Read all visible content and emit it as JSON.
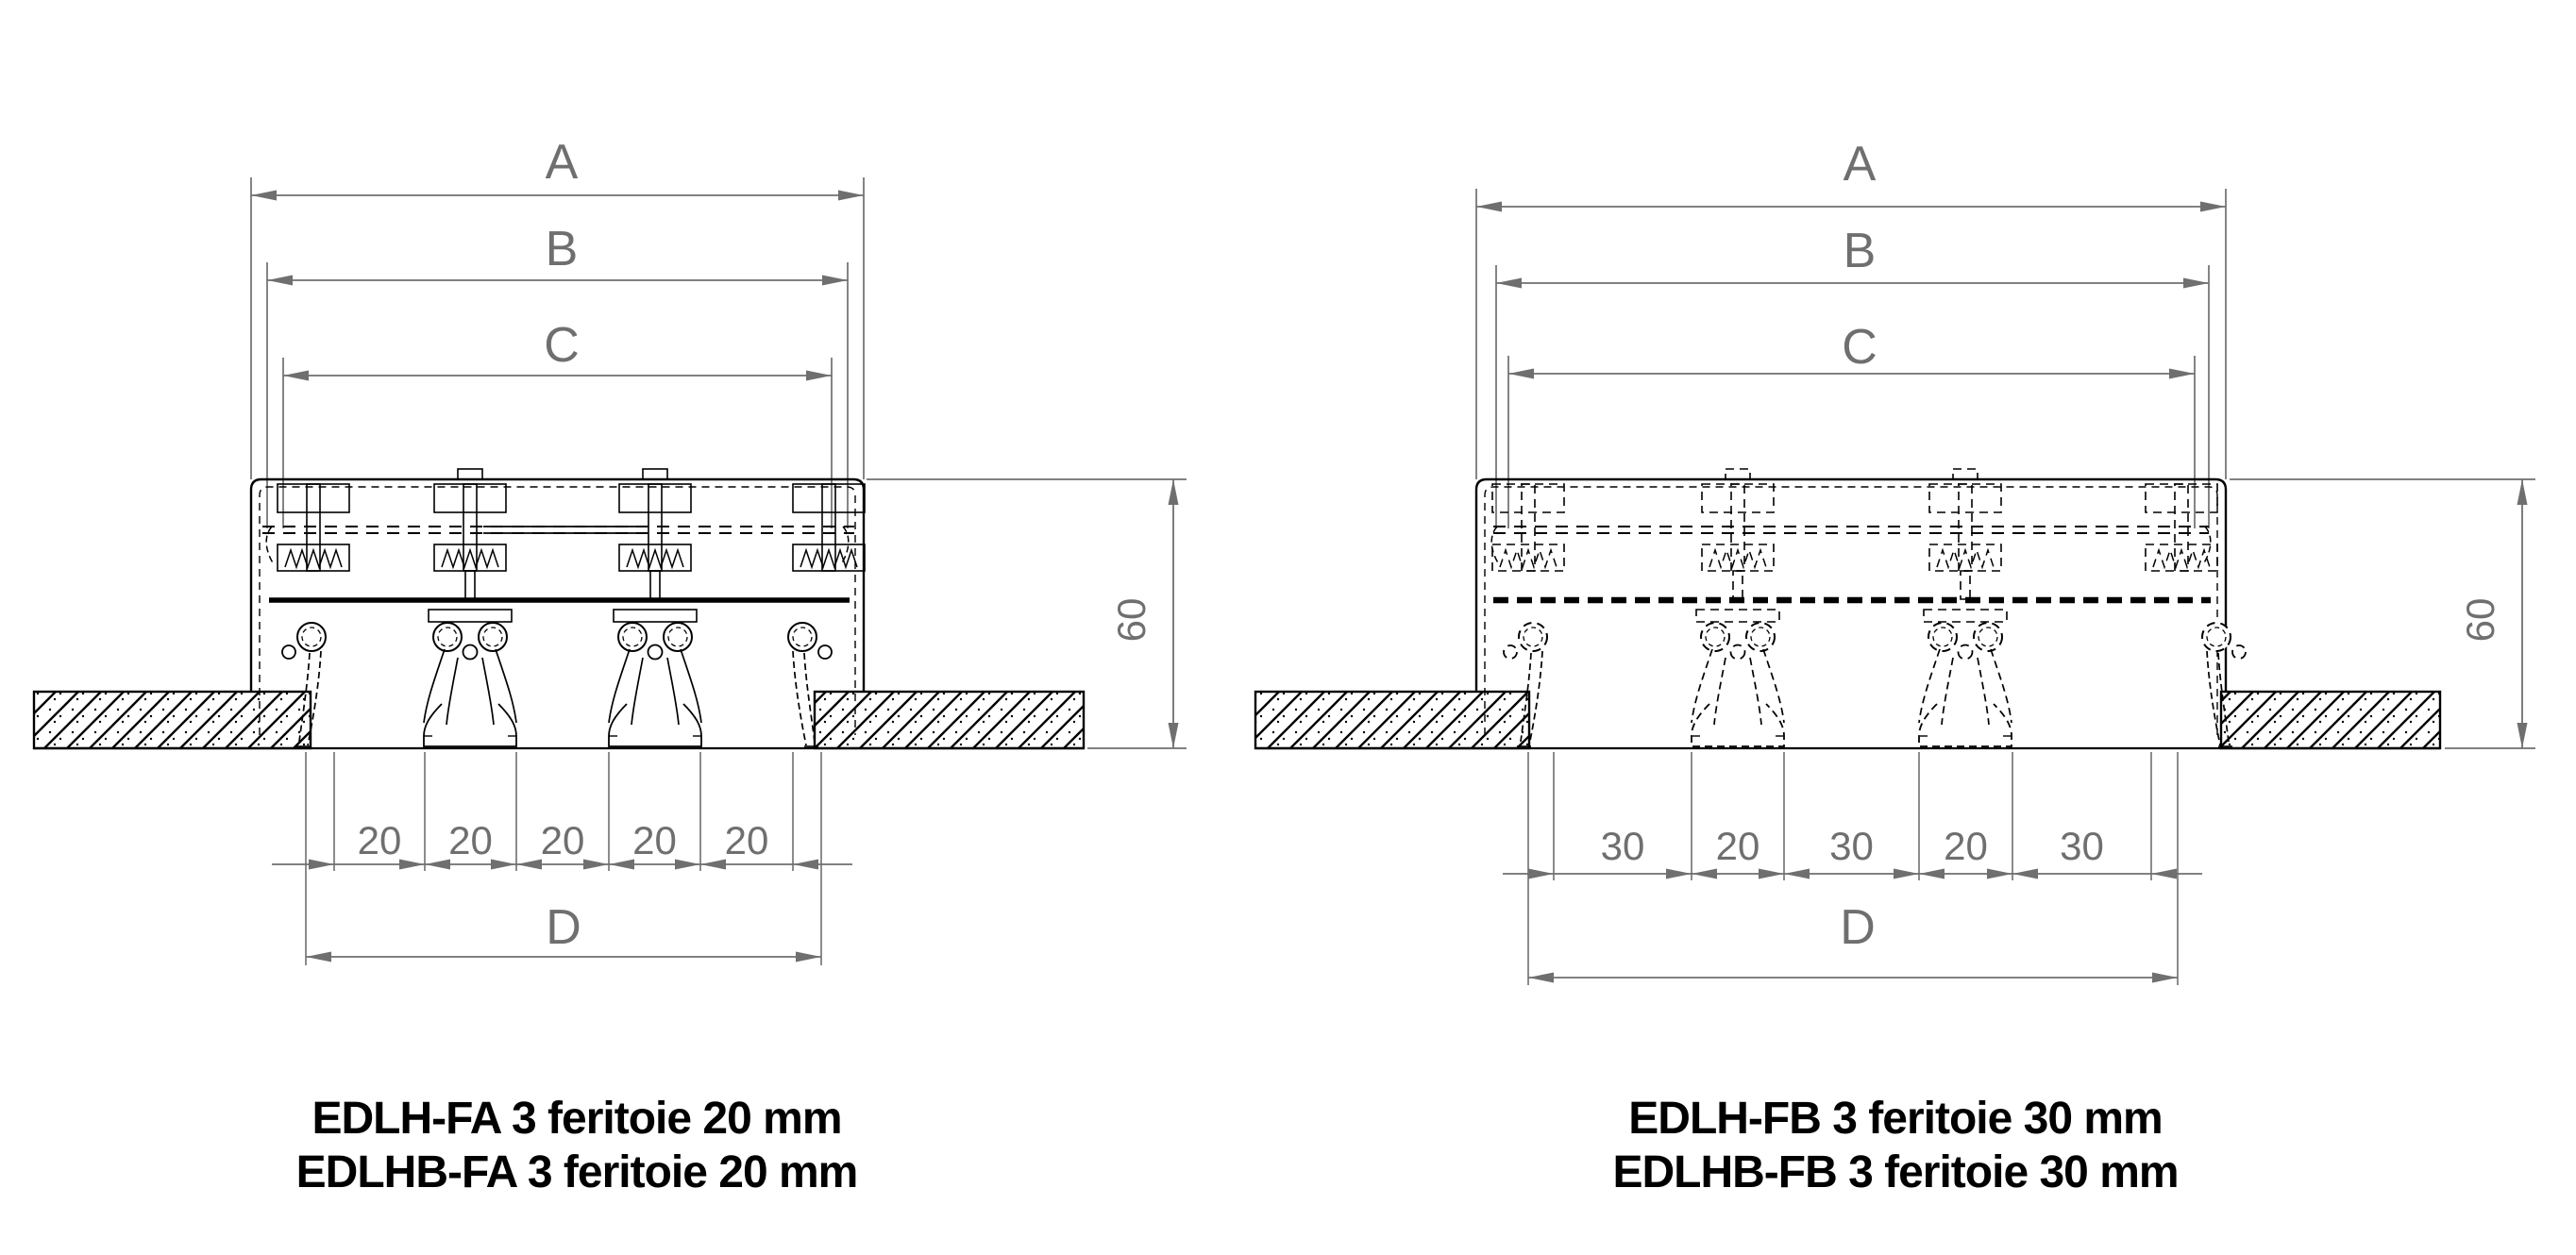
{
  "figure": {
    "background": "#ffffff",
    "ink_color": "#000000",
    "dim_color": "#6f6f6f",
    "drawings": [
      {
        "id": "edlh-fa",
        "line_style": "solid",
        "width_dim_labels": [
          "A",
          "B",
          "C"
        ],
        "slot_width_labels": [
          "20",
          "20",
          "20",
          "20",
          "20"
        ],
        "overall_width_label": "D",
        "height_label": "60",
        "caption_lines": [
          "EDLH-FA 3 feritoie 20 mm",
          "EDLHB-FA 3 feritoie 20 mm"
        ]
      },
      {
        "id": "edlh-fb",
        "line_style": "dashed",
        "width_dim_labels": [
          "A",
          "B",
          "C"
        ],
        "slot_width_labels": [
          "30",
          "20",
          "30",
          "20",
          "30"
        ],
        "overall_width_label": "D",
        "height_label": "60",
        "caption_lines": [
          "EDLH-FB 3 feritoie 30 mm",
          "EDLHB-FB 3 feritoie 30 mm"
        ]
      }
    ]
  }
}
